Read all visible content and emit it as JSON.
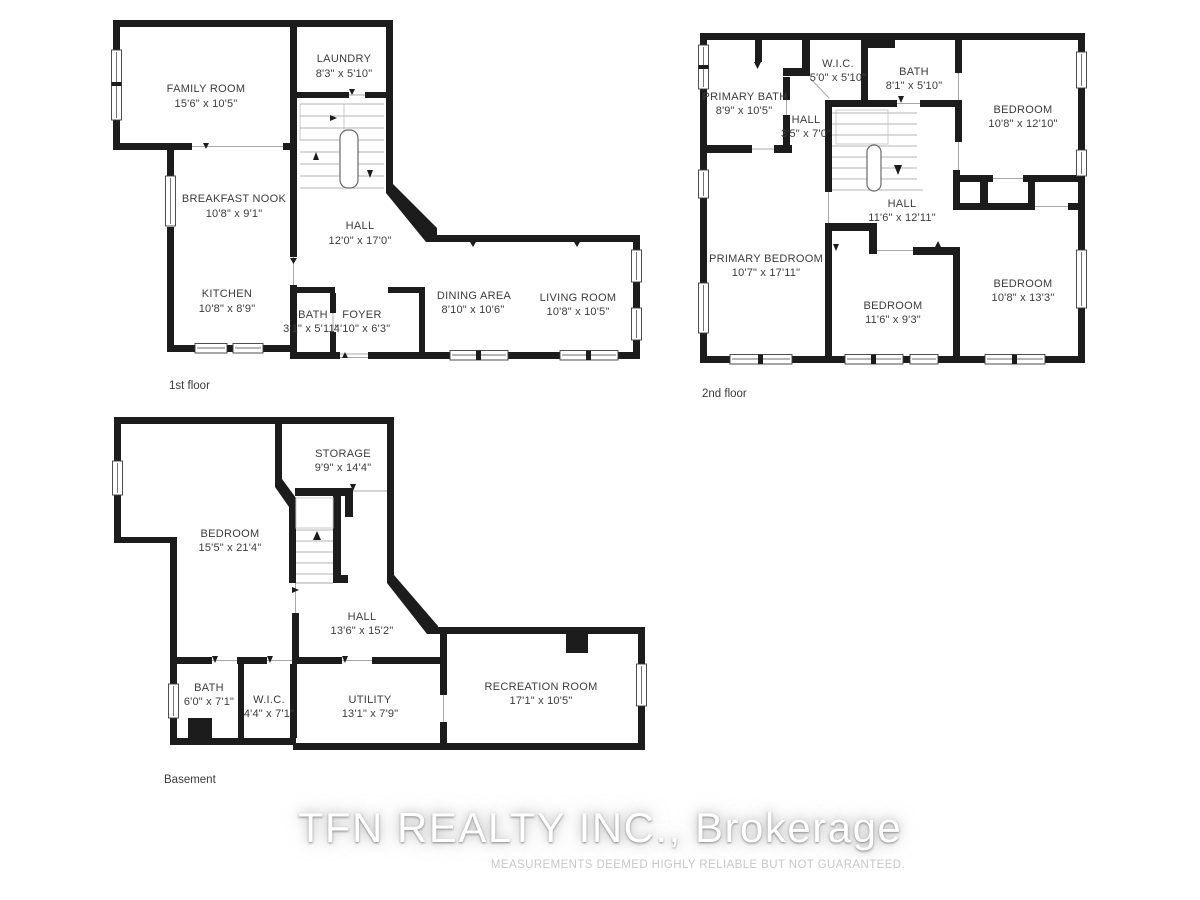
{
  "watermark": {
    "brand": "TFN REALTY INC., Brokerage",
    "disclaimer": "MEASUREMENTS DEEMED HIGHLY RELIABLE BUT NOT GUARANTEED."
  },
  "colors": {
    "wall": "#1c1c1c",
    "label_text": "#3c3c3c",
    "stair_lines": "#b4b4b4",
    "watermark_text": "#ffffff",
    "disclaimer_text": "#c7c7c7"
  },
  "floors": [
    {
      "id": "first",
      "label": "1st floor",
      "rooms": [
        {
          "name": "FAMILY ROOM",
          "dims": "15'6\" x 10'5\""
        },
        {
          "name": "LAUNDRY",
          "dims": "8'3\" x 5'10\""
        },
        {
          "name": "BREAKFAST NOOK",
          "dims": "10'8\" x 9'1\""
        },
        {
          "name": "HALL",
          "dims": "12'0\" x 17'0\""
        },
        {
          "name": "KITCHEN",
          "dims": "10'8\" x 8'9\""
        },
        {
          "name": "BATH",
          "dims": "3'1\" x 5'11\""
        },
        {
          "name": "FOYER",
          "dims": "4'10\" x 6'3\""
        },
        {
          "name": "DINING AREA",
          "dims": "8'10\" x 10'6\""
        },
        {
          "name": "LIVING ROOM",
          "dims": "10'8\" x 10'5\""
        }
      ]
    },
    {
      "id": "second",
      "label": "2nd floor",
      "rooms": [
        {
          "name": "PRIMARY BATH",
          "dims": "8'9\" x 10'5\""
        },
        {
          "name": "W.I.C.",
          "dims": "5'0\" x 5'10\""
        },
        {
          "name": "BATH",
          "dims": "8'1\" x 5'10\""
        },
        {
          "name": "BEDROOM",
          "dims": "10'8\" x 12'10\""
        },
        {
          "name": "HALL",
          "dims": "3'5\" x 7'0\""
        },
        {
          "name": "HALL",
          "dims": "11'6\" x 12'11\""
        },
        {
          "name": "PRIMARY BEDROOM",
          "dims": "10'7\" x 17'11\""
        },
        {
          "name": "BEDROOM",
          "dims": "11'6\" x 9'3\""
        },
        {
          "name": "BEDROOM",
          "dims": "10'8\" x 13'3\""
        }
      ]
    },
    {
      "id": "basement",
      "label": "Basement",
      "rooms": [
        {
          "name": "STORAGE",
          "dims": "9'9\" x 14'4\""
        },
        {
          "name": "BEDROOM",
          "dims": "15'5\" x 21'4\""
        },
        {
          "name": "HALL",
          "dims": "13'6\" x 15'2\""
        },
        {
          "name": "BATH",
          "dims": "6'0\" x 7'1\""
        },
        {
          "name": "W.I.C.",
          "dims": "4'4\" x 7'1\""
        },
        {
          "name": "UTILITY",
          "dims": "13'1\" x 7'9\""
        },
        {
          "name": "RECREATION ROOM",
          "dims": "17'1\" x 10'5\""
        }
      ]
    }
  ]
}
